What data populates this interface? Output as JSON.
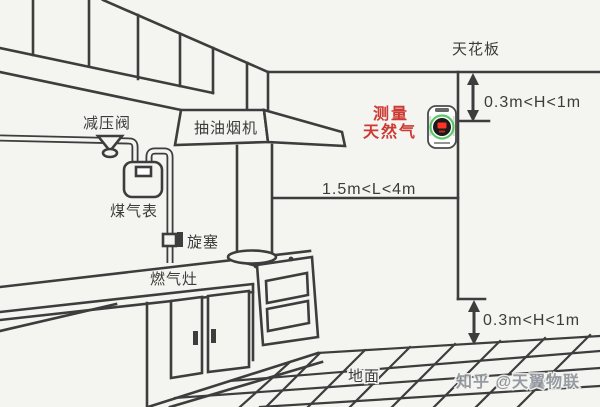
{
  "diagram": {
    "labels": {
      "ceiling": "天花板",
      "range_hood": "抽油烟机",
      "pressure_reducing_valve": "减压阀",
      "gas_meter": "煤气表",
      "plug_valve": "旋塞",
      "gas_stove": "燃气灶",
      "ground": "地面"
    },
    "annotations": {
      "measure_line1": "测量",
      "measure_line2": "天然气",
      "dim_ceiling_offset": "0.3m<H<1m",
      "dim_stove_distance": "1.5m<L<4m",
      "dim_floor_offset": "0.3m<H<1m"
    },
    "watermark": "知乎 @天翼物联",
    "colors": {
      "background": "#f4f4f1",
      "line": "#3d3d3d",
      "text": "#3c3c3c",
      "accent-red": "#cd3a34",
      "detector-green": "#3fbf4f",
      "detector-red": "#ff3326",
      "watermark-gray": "#8e939b"
    }
  }
}
